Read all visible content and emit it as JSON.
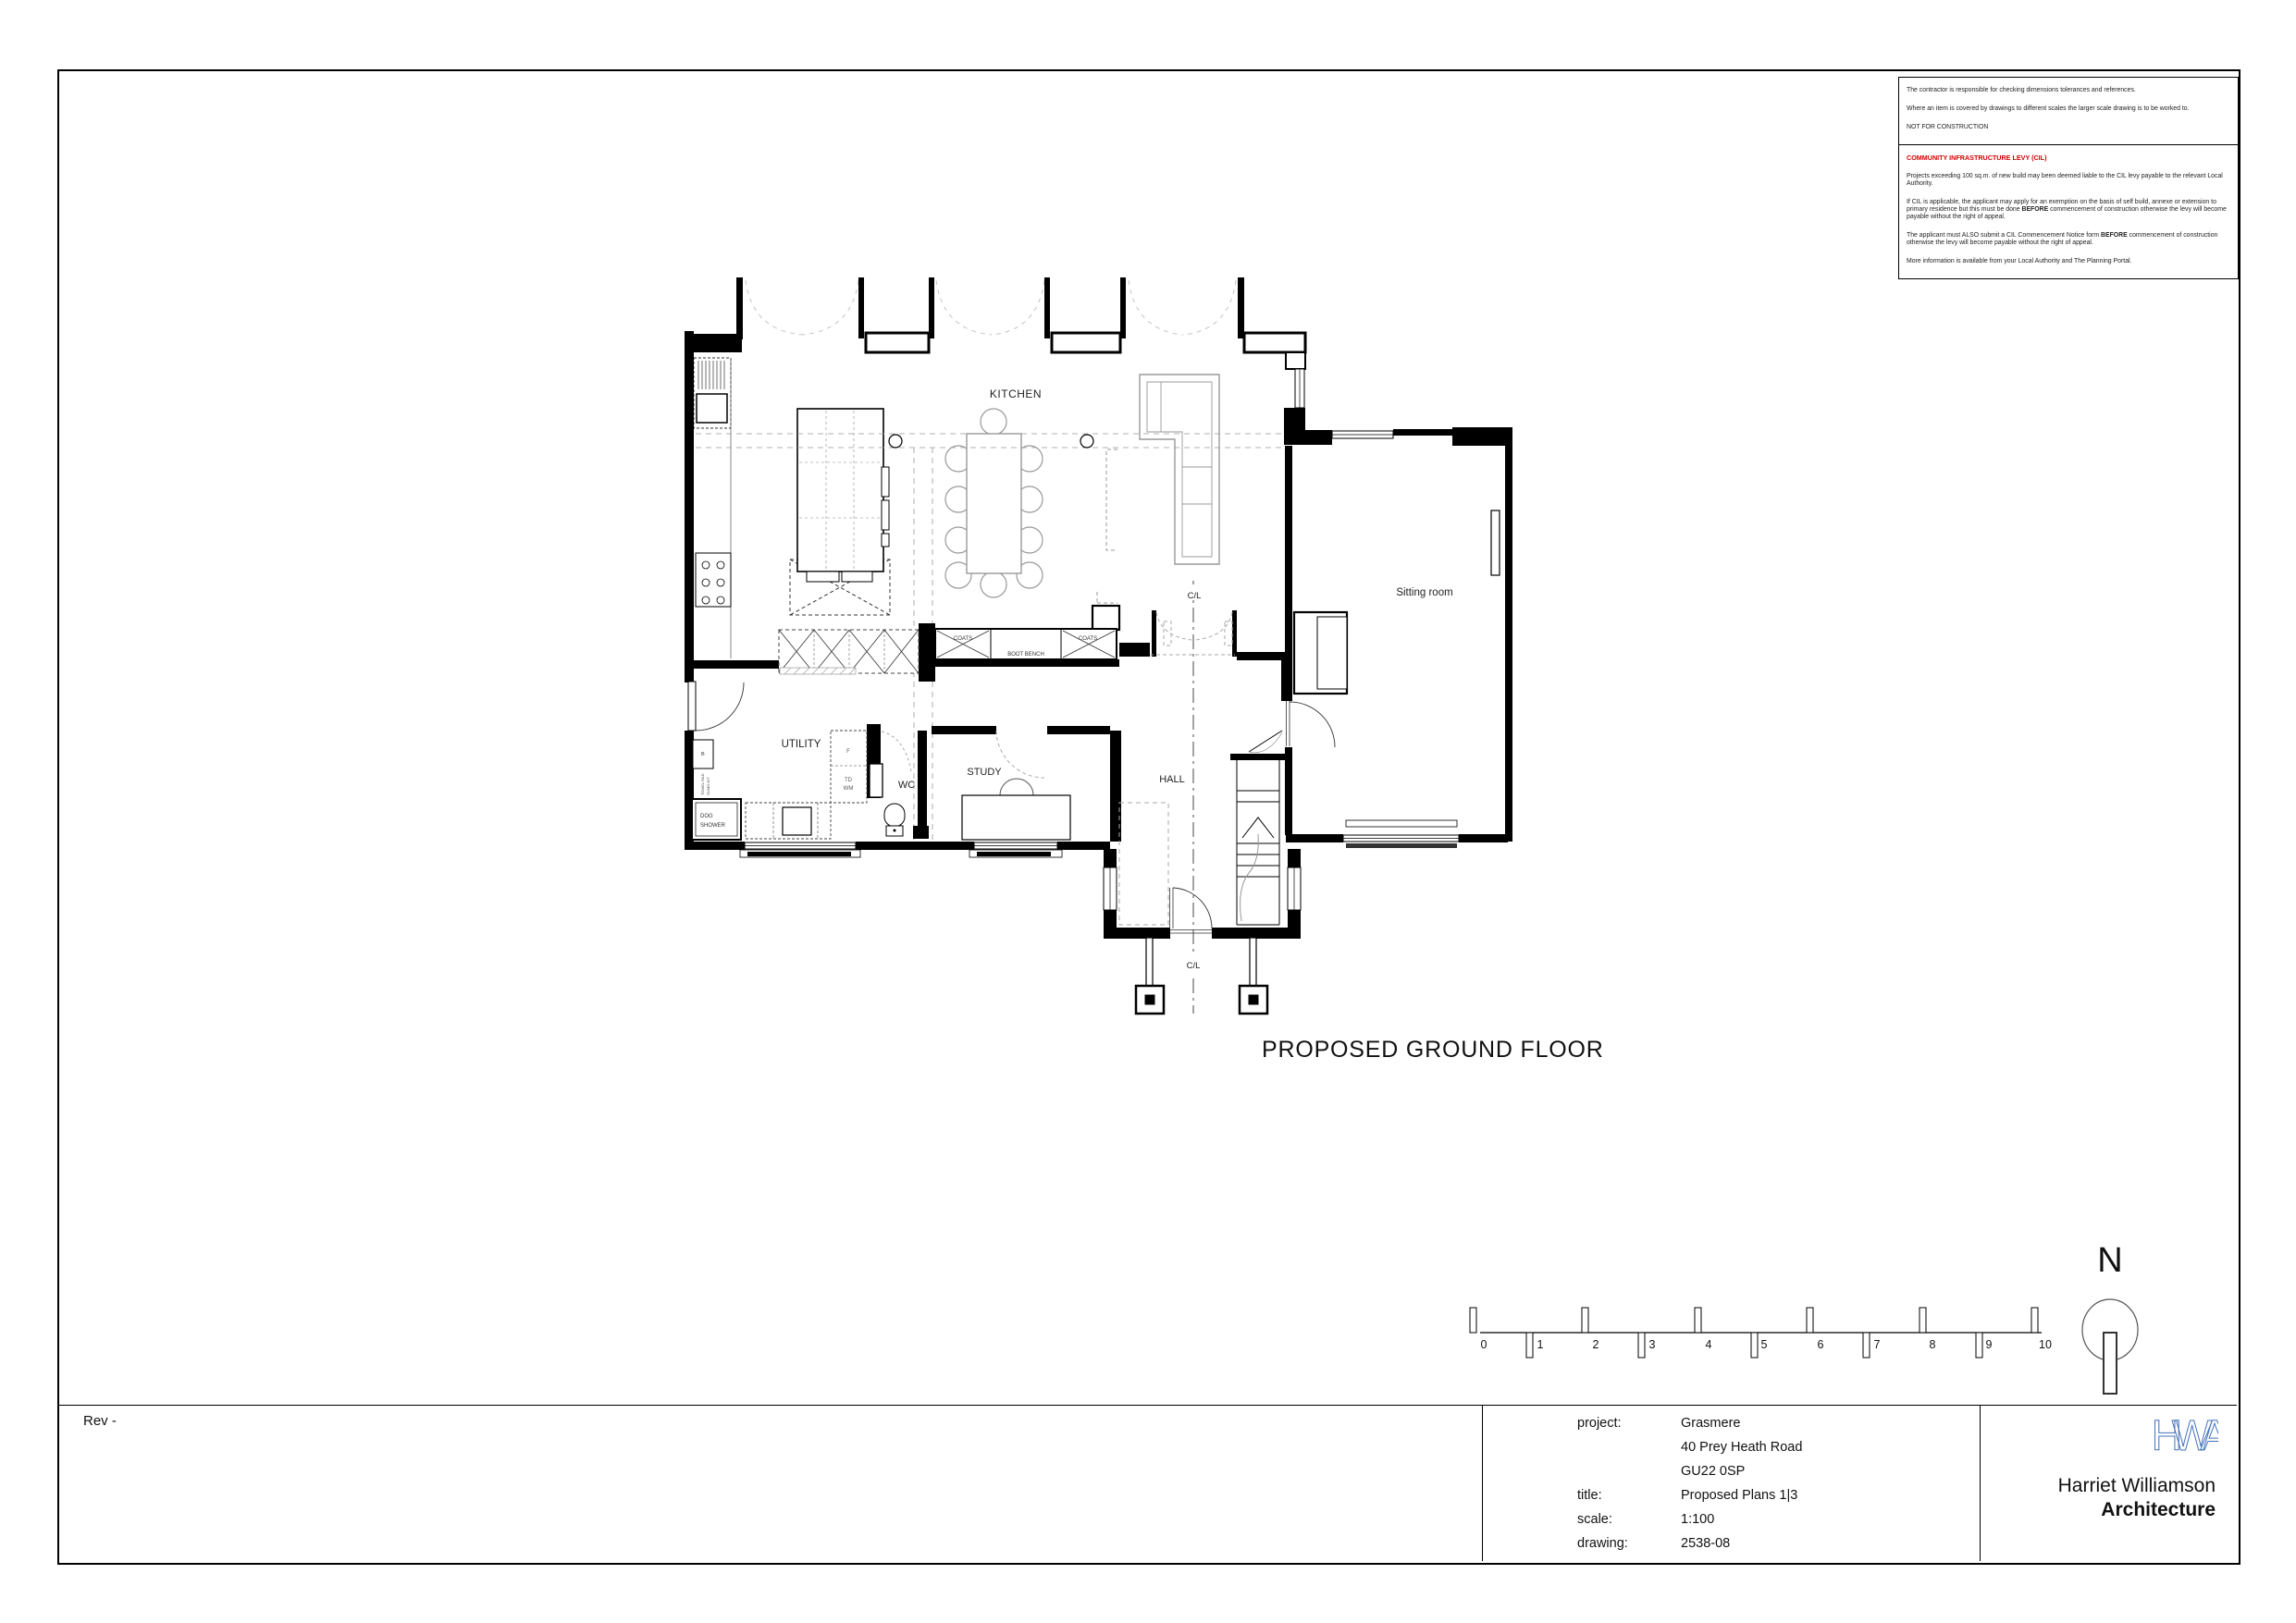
{
  "colors": {
    "accent_red": "#d40000",
    "logo_blue": "#4472b8",
    "wall_black": "#000000",
    "soft_gray": "#999999"
  },
  "notes": {
    "general": [
      "The contractor is responsible for checking dimensions tolerances and references.",
      "Where an item is covered by drawings to different scales the larger scale drawing is to be worked to.",
      "NOT FOR CONSTRUCTION"
    ],
    "cil_heading": "COMMUNITY INFRASTRUCTURE LEVY (CIL)",
    "cil_paragraphs": [
      [
        {
          "t": "Projects exceeding 100 sq.m. of new build may been deemed liable to the CIL levy payable to the relevant Local Authority.",
          "b": false
        }
      ],
      [
        {
          "t": "If CIL is applicable, the applicant may apply for an exemption on the basis of self build, annexe or extension to primary residence but this must be done ",
          "b": false
        },
        {
          "t": "BEFORE",
          "b": true
        },
        {
          "t": " commencement of construction otherwise the levy will become payable without the right of appeal.",
          "b": false
        }
      ],
      [
        {
          "t": "The applicant must ALSO submit a CIL Commencement Notice form ",
          "b": false
        },
        {
          "t": "BEFORE",
          "b": true
        },
        {
          "t": " commencement of construction otherwise the levy will become payable without the right of appeal.",
          "b": false
        }
      ],
      [
        {
          "t": "More information is available from your Local Authority and The Planning Portal.",
          "b": false
        }
      ]
    ]
  },
  "plan": {
    "title": "PROPOSED GROUND FLOOR",
    "kitchen": "KITCHEN",
    "sitting_room": "Sitting room",
    "utility": "UTILITY",
    "study": "STUDY",
    "wc": "WC",
    "hall": "HALL",
    "cl": "C/L",
    "coats": "COATS",
    "boot_bench": "BOOT BENCH",
    "dog_1": "DOG",
    "dog_2": "SHOWER",
    "fridge": "F",
    "td": "TD",
    "wm": "WM",
    "b": "B",
    "towel_rad": "TOWEL RAD",
    "towel_rad2": "SLIMO KIT"
  },
  "scale_bar": {
    "numbers": [
      "0",
      "1",
      "2",
      "3",
      "4",
      "5",
      "6",
      "7",
      "8",
      "9",
      "10"
    ]
  },
  "north": {
    "letter": "N"
  },
  "rev": "Rev -",
  "title_block": {
    "rows": [
      {
        "label": "project:",
        "value": "Grasmere"
      },
      {
        "label": "",
        "value": "40 Prey Heath Road"
      },
      {
        "label": "",
        "value": "GU22 0SP"
      },
      {
        "label": "title:",
        "value": "Proposed Plans 1|3"
      },
      {
        "label": "scale:",
        "value": "1:100"
      },
      {
        "label": "drawing:",
        "value": "2538-08"
      }
    ]
  },
  "firm": {
    "logo_text": "HWA",
    "name": "Harriet Williamson",
    "discipline": "Architecture"
  }
}
